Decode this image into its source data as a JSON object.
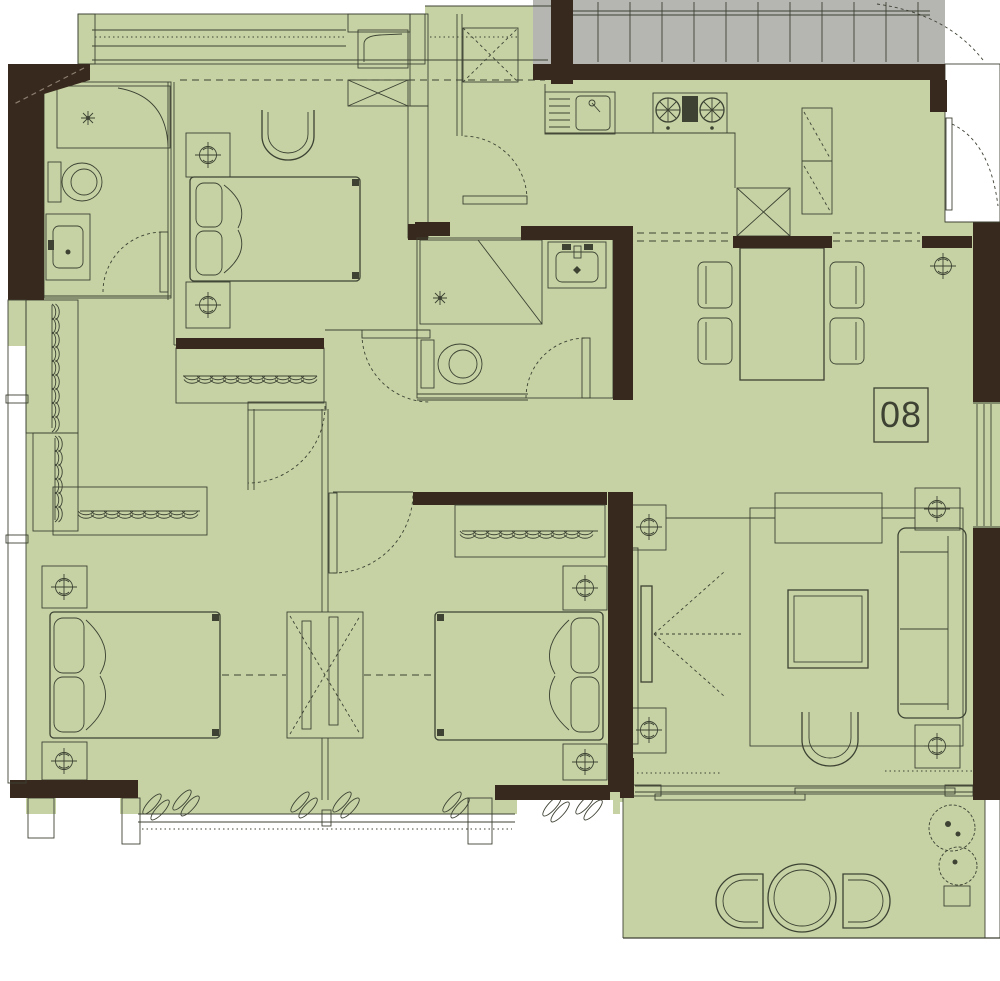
{
  "unit": {
    "label": "08"
  },
  "plan": {
    "type": "residential-apartment-floor-plan",
    "rooms": [
      {
        "id": "bathroom-1",
        "furniture": [
          "shower",
          "toilet",
          "vanity-sink",
          "door"
        ]
      },
      {
        "id": "bedroom-1",
        "furniture": [
          "double-bed",
          "nightstand-lamp",
          "nightstand-lamp",
          "chair",
          "cabinet",
          "service-shaft"
        ]
      },
      {
        "id": "bathroom-2",
        "furniture": [
          "shower",
          "toilet",
          "vanity-sink",
          "door"
        ]
      },
      {
        "id": "kitchen",
        "furniture": [
          "sink",
          "dish-rack",
          "cooktop",
          "refrigerator",
          "tall-cabinet"
        ]
      },
      {
        "id": "entry-corridor",
        "furniture": [
          "entrance-door",
          "ceiling-lamp"
        ]
      },
      {
        "id": "dining-room",
        "furniture": [
          "dining-table",
          "chair",
          "chair",
          "chair",
          "chair"
        ]
      },
      {
        "id": "hallway",
        "furniture": [
          "wardrobe-hangers",
          "wardrobe-hangers",
          "wardrobe-hangers"
        ]
      },
      {
        "id": "bedroom-2",
        "furniture": [
          "double-bed",
          "nightstand-lamp",
          "nightstand-lamp",
          "sliding-partition",
          "bay-window",
          "curtains"
        ]
      },
      {
        "id": "bedroom-3",
        "furniture": [
          "double-bed",
          "nightstand-lamp",
          "nightstand-lamp",
          "wardrobe-hangers",
          "bay-window",
          "curtains"
        ]
      },
      {
        "id": "living-room",
        "furniture": [
          "tv",
          "sofa",
          "coffee-table",
          "armchair",
          "console-table",
          "rug",
          "lamp",
          "lamp",
          "lamp",
          "lamp"
        ]
      },
      {
        "id": "balcony",
        "furniture": [
          "round-table",
          "patio-chair",
          "patio-chair",
          "plants"
        ]
      },
      {
        "id": "stairwell",
        "furniture": [
          "stairs"
        ]
      }
    ]
  },
  "colors": {
    "floor": "#c6d2a4",
    "wall": "#38291e",
    "stair": "#b5b5b2",
    "line": "#3d4233",
    "hatch": "#55503f",
    "white": "#ffffff",
    "dash_light": "#8a7f6f",
    "text": "#3d4233"
  }
}
